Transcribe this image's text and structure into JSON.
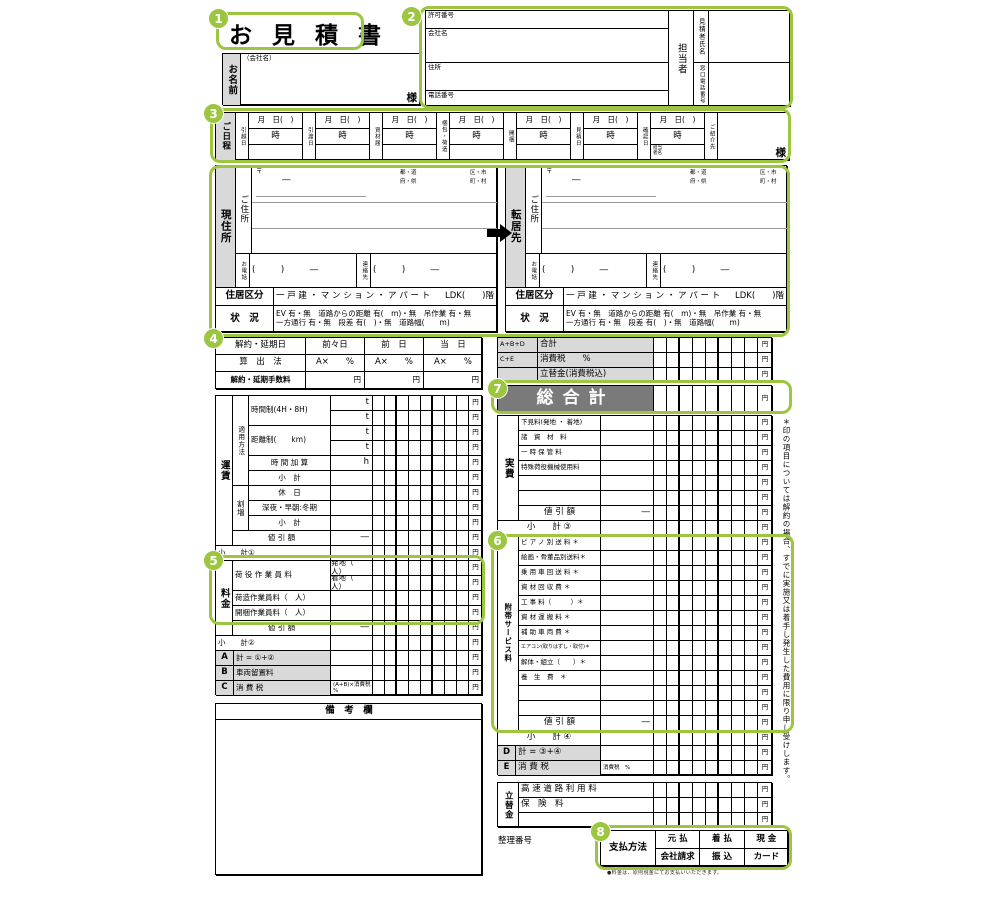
{
  "title": "お 見 積 書",
  "yen": "円",
  "badges": [
    "1",
    "2",
    "3",
    "4",
    "5",
    "6",
    "7",
    "8"
  ],
  "customer": {
    "label": "お名前",
    "hint": "（会社名）",
    "honorific": "様"
  },
  "company": {
    "permit": "許可番号",
    "name": "会社名",
    "address": "住所",
    "phone": "電話番号",
    "staff": "担当者",
    "estimator": "見積者氏名",
    "window_phone": "窓口電話番号"
  },
  "schedule": {
    "header": "ご日程",
    "date_placeholder": "月　日(　)",
    "time_label": "時",
    "columns": [
      "引越日",
      "引渡日",
      "資材届",
      "梱包・荷造",
      "開梱",
      "見積日",
      "確認日"
    ],
    "staff_note": "担当者名",
    "referral_label": "ご紹介先",
    "honorific": "様"
  },
  "address": {
    "current_header": "現住所",
    "new_header": "転居先",
    "addr_label": "ご住所",
    "postal_mark": "〒",
    "dash": "―",
    "pref1": "都・道",
    "pref2": "府・県",
    "city1": "区・市",
    "city2": "町・村",
    "phone_label": "お電話",
    "phone_value": "(　　　)　　　―",
    "contact_label": "連絡先",
    "contact_value": "(　　　)　　　―",
    "housing_label": "住居区分",
    "housing_options": "一 戸 建 ・ マ ン シ ョ ン ・ ア パ ー ト",
    "housing_ldk": "LDK(　　)階",
    "cond_label": "状　況",
    "cond1": "EV 有・無　道路からの距離 有(　m)・無　吊作業 有・無",
    "cond2": "一方通行 有・無　段差 有(　)・無　道路幅(　　m)"
  },
  "cancellation": {
    "date_label": "解約・延期日",
    "cols": [
      "前々日",
      "前　日",
      "当　日"
    ],
    "calc_label": "算　出　法",
    "calc_value": "A×　　%",
    "fee_label": "解約・延期手数料"
  },
  "freight": {
    "vheader": "運賃",
    "vsub1": "適用方法",
    "vsub2": "割増",
    "vheader2": "料金",
    "rows": [
      {
        "mid": "t",
        "ind": 2
      },
      {
        "mid": "t",
        "ind": 2
      },
      {
        "mid": "t",
        "ind": 2
      },
      {
        "mid": "t",
        "ind": 2
      },
      {
        "label": "時 間 加 算",
        "c": 1,
        "mid": "h",
        "ind": 2
      },
      {
        "label": "小　計",
        "c": 1,
        "ind": 2
      },
      {
        "label": "休　日",
        "c": 1,
        "ind": 2
      },
      {
        "label": "深夜・早朝:冬期",
        "c": 1,
        "ind": 2
      },
      {
        "label": "小　計",
        "c": 1,
        "ind": 2
      },
      {
        "label": "値 引 額",
        "c": 1,
        "mid": "―",
        "ind": 1
      },
      {
        "label": "小　　計①",
        "wide": 1
      },
      {
        "mid": "発地（　人）",
        "ind": 1
      },
      {
        "mid": "着地（　人）",
        "ind": 1
      },
      {
        "label": "荷造作業員料（　人）",
        "ind": 1
      },
      {
        "label": "開梱作業員料（　人）",
        "ind": 1
      },
      {
        "label": "値 引 額",
        "c": 1,
        "mid": "―",
        "ind": 1
      },
      {
        "label": "小　　計②",
        "wide": 1
      },
      {
        "code": "A",
        "label": "計 = ①+②"
      },
      {
        "code": "B",
        "label": "車両留置料"
      },
      {
        "code": "C",
        "label": "消 費 税",
        "mid": "(A+B)×消費税　%",
        "sm": 1
      }
    ],
    "spans": [
      {
        "label": "時間制(4H・8H)",
        "row": 0,
        "n": 2,
        "ind": 2
      },
      {
        "label": "距離制(　　km)",
        "row": 2,
        "n": 2,
        "ind": 2
      },
      {
        "label": "荷 役 作 業 員 料",
        "row": 11,
        "n": 2,
        "ind": 1
      }
    ]
  },
  "remarks_header": "備　考　欄",
  "right": {
    "summary": [
      {
        "code": "A+B+D",
        "label": "合計"
      },
      {
        "code": "C+E",
        "label": "消費税　　%"
      },
      {
        "code": "",
        "label": "立替金(消費税込)"
      }
    ],
    "grand_total": "総合計",
    "actual": {
      "vheader": "実費",
      "rows": [
        "下見料(発地 ・ 着地)",
        "諸　資　材　料",
        "一 時 保 管 料",
        "特殊荷役機械使用料",
        "",
        "",
        "値 引 額"
      ],
      "subtotal": "小　　計 ③"
    },
    "services": {
      "vheader": "附帯サービス料",
      "rows": [
        "ピ ア ノ 別 送 料 ＊",
        "絵画・骨董品別送料＊",
        "乗 用 車 回 送 料 ＊",
        "資 材 回 収 費 ＊",
        "工 事 料（　　　）＊",
        "資 材 運 搬 料 ＊",
        "補 助 車 両 費 ＊",
        "エアコン(取りはずし・取付)＊",
        "解体・組立（　　）＊",
        "養　生　費　＊",
        "",
        "",
        "値 引 額"
      ],
      "subtotal": "小　　計 ④"
    },
    "de": [
      {
        "code": "D",
        "label": "計 = ③+④",
        "mid": ""
      },
      {
        "code": "E",
        "label": "消 費 税",
        "mid": "消費税　%"
      }
    ],
    "advance": {
      "vheader": "立替金",
      "rows": [
        "高 速 道 路 利 用 料",
        "保　険　料",
        ""
      ]
    }
  },
  "reference_label": "整理番号",
  "payment": {
    "label": "支払方法",
    "row1": [
      "元 払",
      "着 払",
      "現 金"
    ],
    "row2": [
      "会社請求",
      "振 込",
      "カード"
    ]
  },
  "footnote": "●料金は、原則現金にてお支払いいただきます。",
  "side_note": "＊印の項目については解約の場合、すでに実施又は着手し発生した費用に限り申し受けします。"
}
